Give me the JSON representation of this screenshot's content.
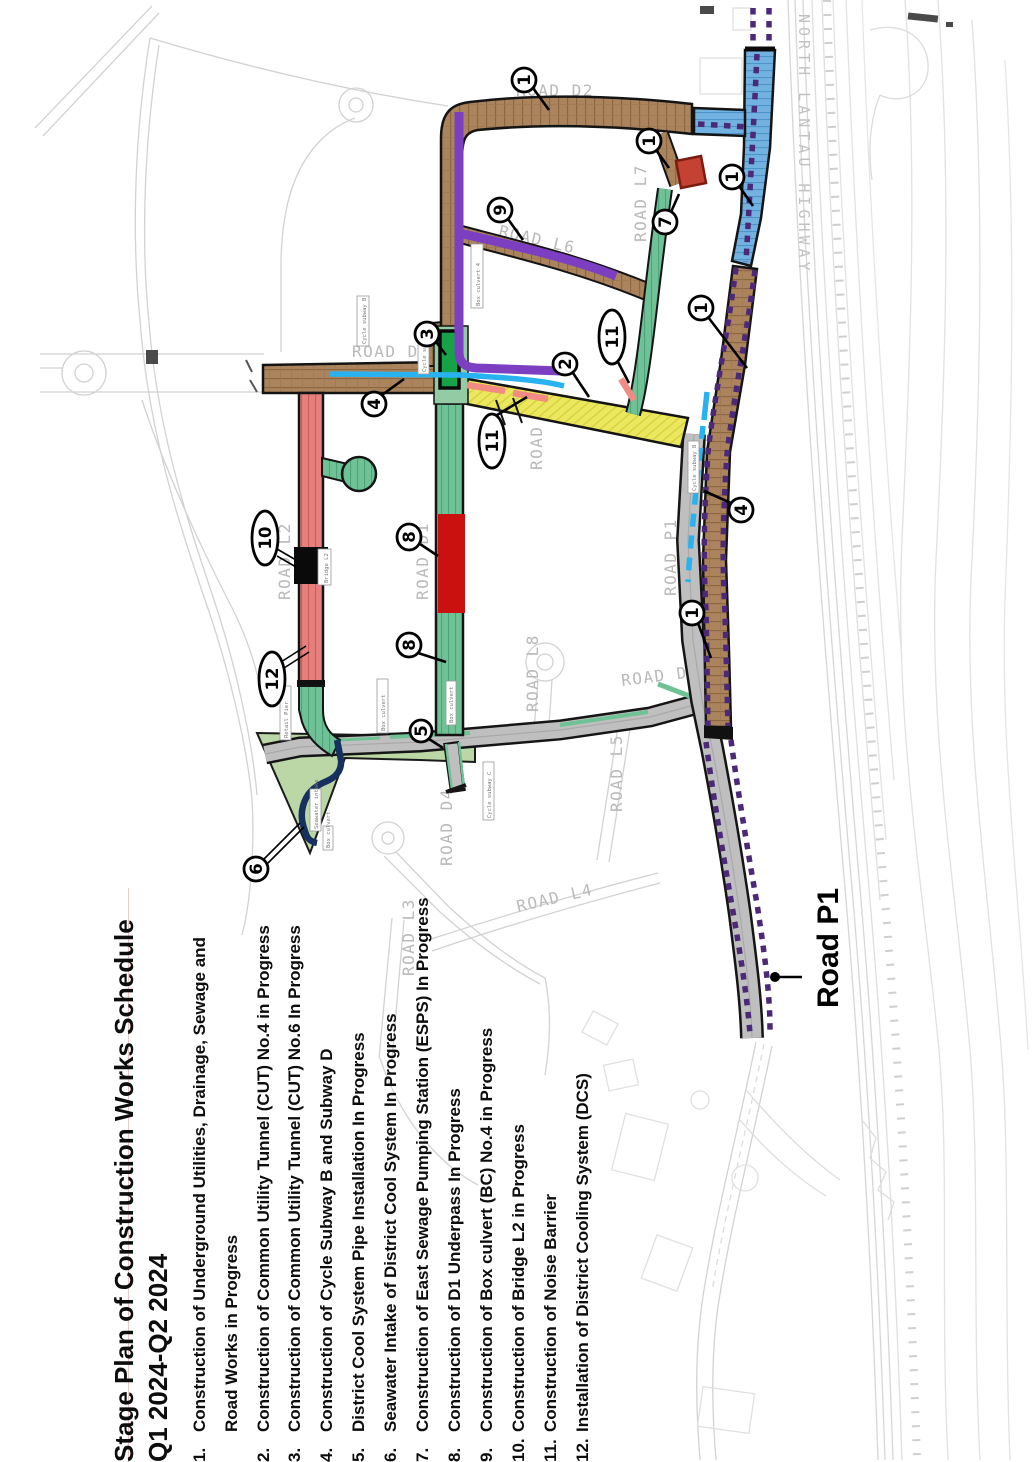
{
  "page": {
    "title_line1": "Stage Plan of Construction Works Schedule",
    "title_line2": "Q1 2024-Q2 2024"
  },
  "legend": {
    "items": [
      {
        "num": "1.",
        "text": "Construction of Underground Utilities, Drainage, Sewage and Road Works in Progress"
      },
      {
        "num": "2.",
        "text": "Construction of Common Utility Tunnel (CUT) No.4 in Progress"
      },
      {
        "num": "3.",
        "text": "Construction of Common Utility Tunnel (CUT) No.6 In Progress"
      },
      {
        "num": "4.",
        "text": "Construction of Cycle Subway B and Subway D"
      },
      {
        "num": "5.",
        "text": "District Cool System Pipe Installation In Progress"
      },
      {
        "num": "6.",
        "text": "Seawater Intake of District Cool System In Progress"
      },
      {
        "num": "7.",
        "text": "Construction of East Sewage Pumping Station (ESPS) In Progress"
      },
      {
        "num": "8.",
        "text": "Construction of D1 Underpass In Progress"
      },
      {
        "num": "9.",
        "text": "Construction of Box culvert (BC) No.4 in Progress"
      },
      {
        "num": "10.",
        "text": "Construction of Bridge L2 in Progress"
      },
      {
        "num": "11.",
        "text": "Construction of Noise Barrier"
      },
      {
        "num": "12.",
        "text": "Installation of District Cooling System (DCS)"
      }
    ]
  },
  "map": {
    "road_p1_label": "Road P1",
    "cad_labels": {
      "d2": "ROAD D2",
      "l6": "ROAD L6",
      "d3": "ROAD D3",
      "l7": "ROAD L7",
      "l2": "ROAD L2",
      "d1": "ROAD D1",
      "l9": "ROAD L9",
      "l8": "ROAD L8",
      "l5": "ROAD L5",
      "d4": "ROAD D4",
      "l4": "ROAD L4",
      "l3": "ROAD L3",
      "d5": "ROAD D5",
      "p1": "ROAD P1",
      "highway": "NORTH LANTAU HIGHWAY"
    },
    "micro_labels": {
      "cycle_subway_b": "Cycle subway B",
      "box_culvert_4": "Box culvert 4",
      "bridge_l2": "Bridge L2",
      "seawater_intake": "Seawater intake",
      "retail_pier": "Retail Pier",
      "box_culvert": "Box culvert",
      "cycle_subway_c": "Cycle subway C"
    },
    "callouts": [
      "1",
      "1",
      "1",
      "1",
      "3",
      "4",
      "9",
      "7",
      "11",
      "2",
      "11",
      "10",
      "8",
      "8",
      "12",
      "5",
      "6",
      "4",
      "1"
    ],
    "colors": {
      "brown_road": "#ab835c",
      "green_road": "#6fc295",
      "red_road": "#e5807c",
      "blue_road": "#72b2e0",
      "yellow_road": "#ebe75e",
      "light_green_area": "#bad7a5",
      "purple_line": "#7d3fc1",
      "purple_dotted": "#4b2878",
      "cyan_line": "#29b2f0",
      "pink_dash": "#f28b82",
      "navy_line": "#16315f",
      "red_block": "#cb1010",
      "esps_block": "#c44233",
      "underpass_green": "#16a348",
      "noise_barrier": "#0a0a0a"
    }
  }
}
